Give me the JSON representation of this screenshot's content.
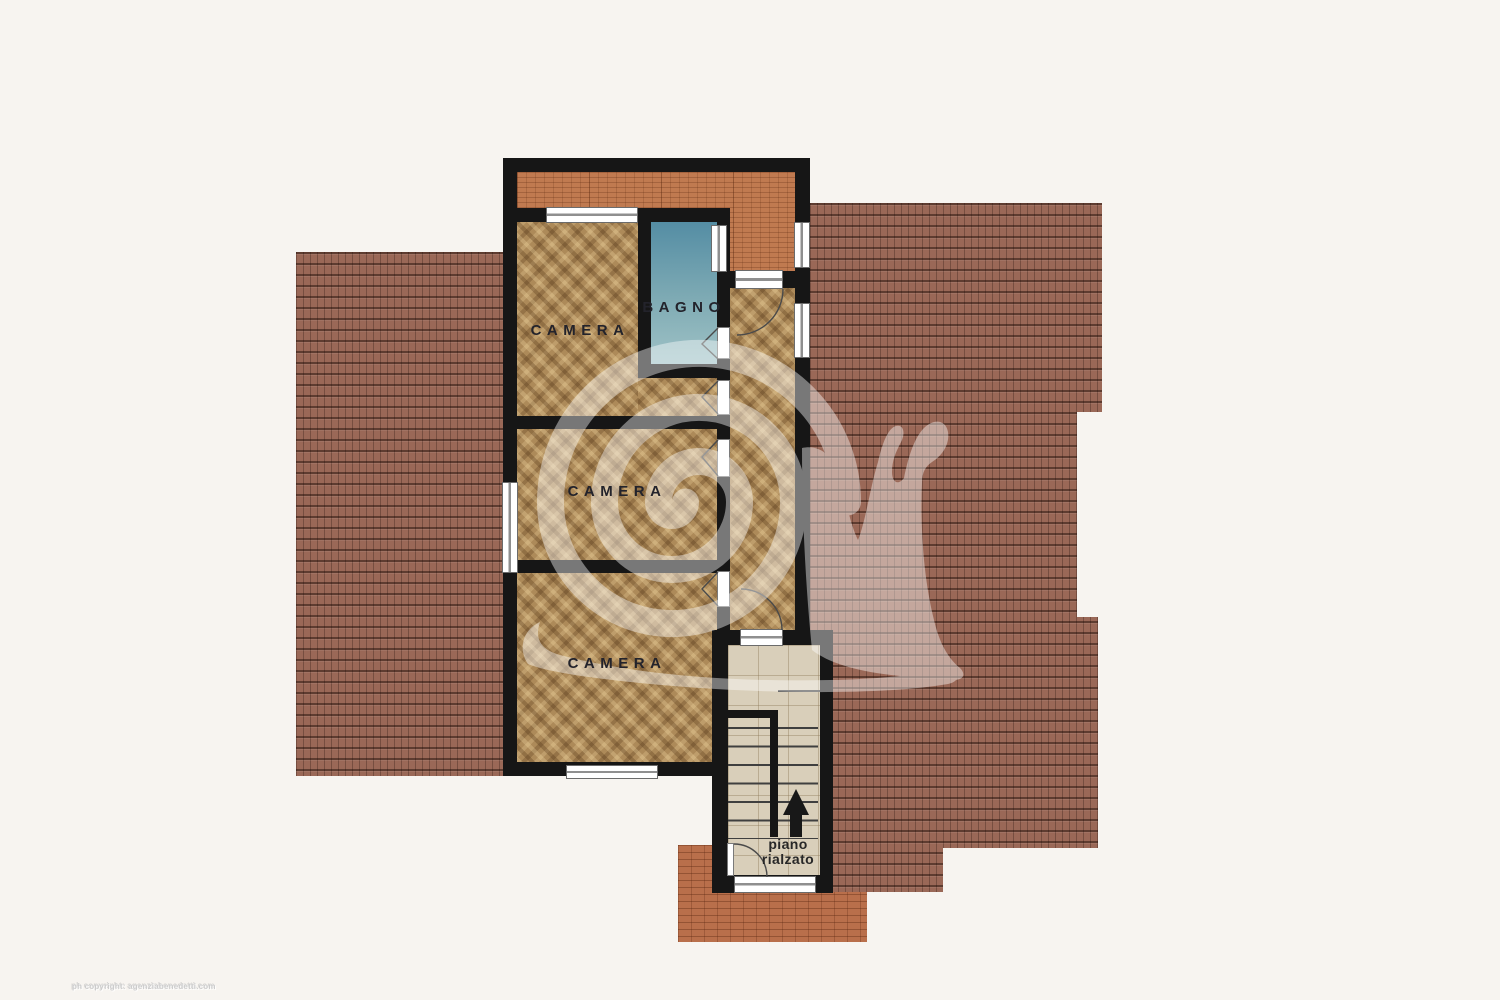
{
  "plan": {
    "rooms": {
      "camera1": {
        "label": "CAMERA",
        "floor": "parquet"
      },
      "camera2": {
        "label": "CAMERA",
        "floor": "parquet"
      },
      "camera3": {
        "label": "CAMERA",
        "floor": "parquet"
      },
      "bagno": {
        "label": "BAGNO",
        "floor": "blue-ceramic"
      },
      "corridoio": {
        "label": "",
        "floor": "parquet"
      },
      "stairwell": {
        "label_line1": "piano",
        "label_line2": "rialzato",
        "floor": "beige-tile",
        "arrow": "up"
      }
    },
    "outdoor": {
      "roof_left": "tiled-roof",
      "roof_right": "tiled-roof",
      "terrace_top": "brick-terrace",
      "terrace_bottom": "brick-terrace"
    }
  },
  "watermark": {
    "shape": "snail-spiral-logo",
    "color": "rgba(255,255,255,0.42)"
  },
  "footer": {
    "copyright": "ph copyright: agenziabenedetti.com"
  },
  "colors": {
    "bg": "#f7f4f0",
    "wall": "#161616",
    "parquet": "#ad8a59",
    "bagno-top": "#548da4",
    "bagno-bottom": "#9fc2c6",
    "roof": "#9a6857",
    "terr-top": "#c07a50",
    "terr-bottom": "#b96f4b",
    "stairs": "#d9cfba",
    "label": "#23232b",
    "copyright": "#cccccc"
  }
}
